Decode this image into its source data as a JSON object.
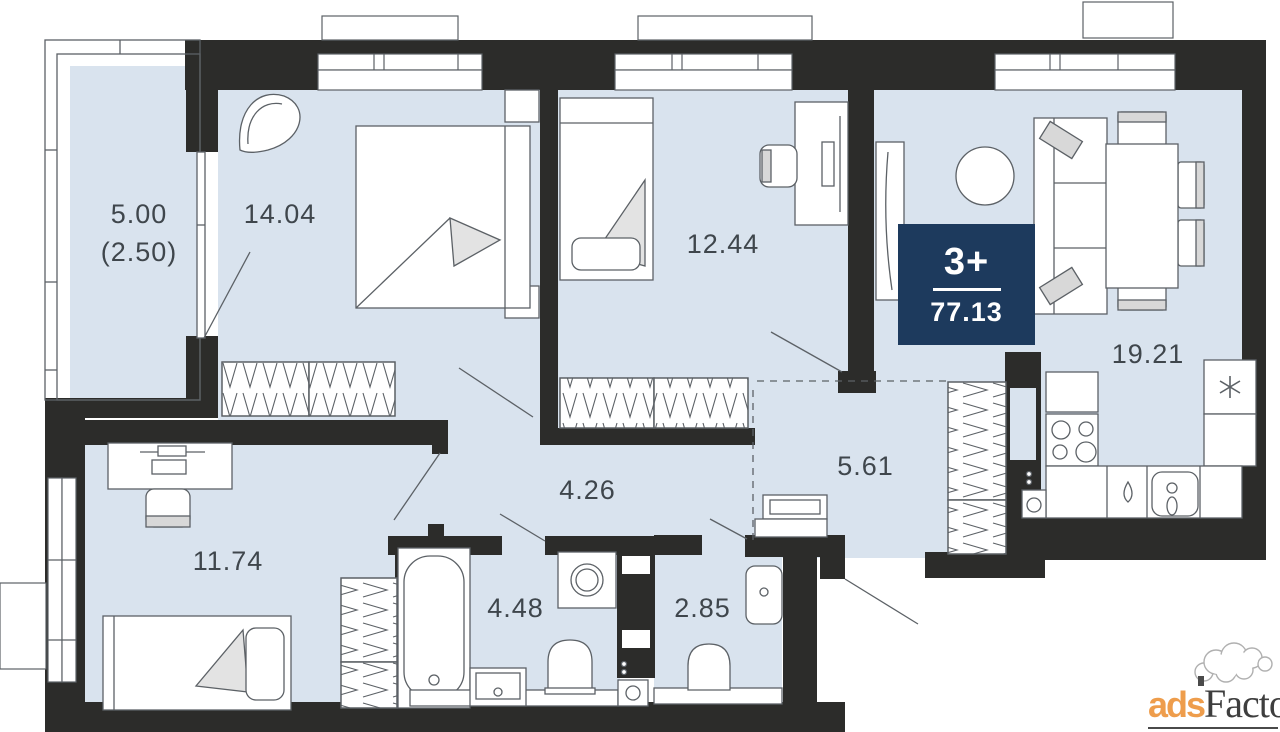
{
  "badge": {
    "rooms": "3+",
    "total_area": "77.13"
  },
  "rooms": [
    {
      "name": "balcony",
      "area": "5.00",
      "reduced_area": "(2.50)"
    },
    {
      "name": "bedroom-1",
      "area": "14.04"
    },
    {
      "name": "bedroom-2",
      "area": "12.44"
    },
    {
      "name": "living-kitchen",
      "area": "19.21"
    },
    {
      "name": "hallway",
      "area": "4.26"
    },
    {
      "name": "corridor",
      "area": "5.61"
    },
    {
      "name": "bedroom-3",
      "area": "11.74"
    },
    {
      "name": "bathroom",
      "area": "4.48"
    },
    {
      "name": "toilet",
      "area": "2.85"
    }
  ],
  "watermark": {
    "part1": "ads",
    "part2": "Factory"
  },
  "colors": {
    "wall": "#2c2c2a",
    "room_fill": "#d9e3ee",
    "badge_bg": "#1d3a5d",
    "badge_text": "#ffffff",
    "label_text": "#3f464c",
    "furniture_line": "#5c6166",
    "watermark_orange": "#ee9d4c",
    "watermark_dark": "#3e3e3e"
  }
}
